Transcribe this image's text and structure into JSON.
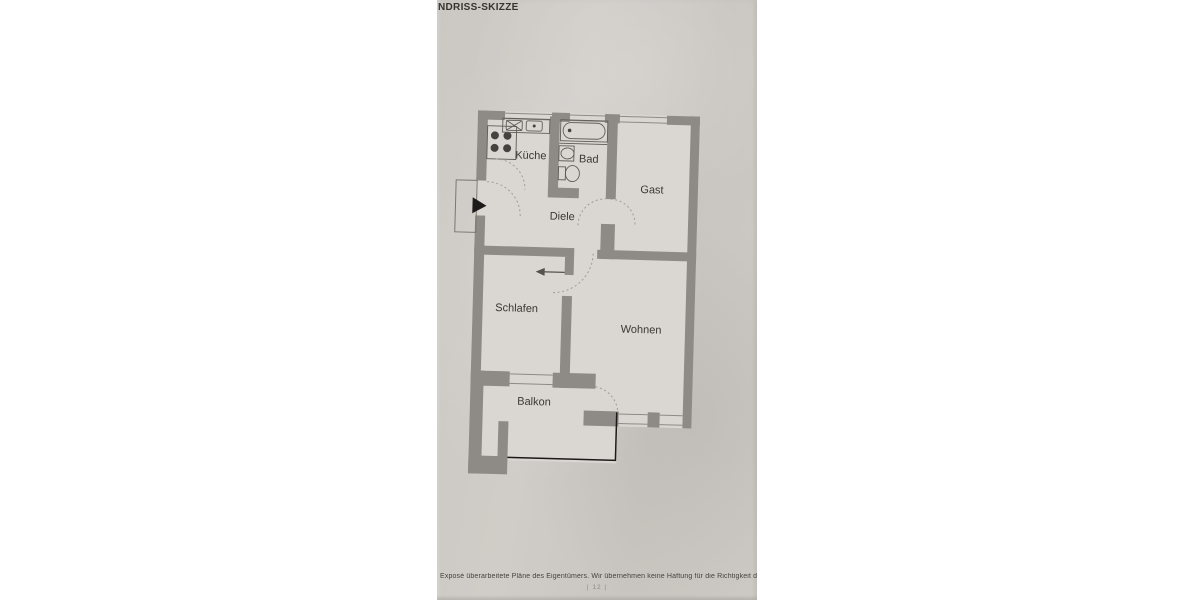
{
  "title": "NDRISS-SKIZZE",
  "rooms": {
    "kueche": "Küche",
    "bad": "Bad",
    "gast": "Gast",
    "diele": "Diele",
    "schlafen": "Schlafen",
    "wohnen": "Wohnen",
    "balkon": "Balkon"
  },
  "footer": {
    "disclaimer": "Exposé überarbeitete Pläne des Eigentümers. Wir übernehmen keine Haftung für die Richtigkeit der Angab",
    "page_number": "| 12 |"
  },
  "colors": {
    "paper": "#cdc9c4",
    "wall": "#8e8a85",
    "room_fill": "#dad6d1",
    "ink": "#3a3834",
    "entry_arrow": "#1c1b19",
    "railing": "#1a1a18"
  }
}
